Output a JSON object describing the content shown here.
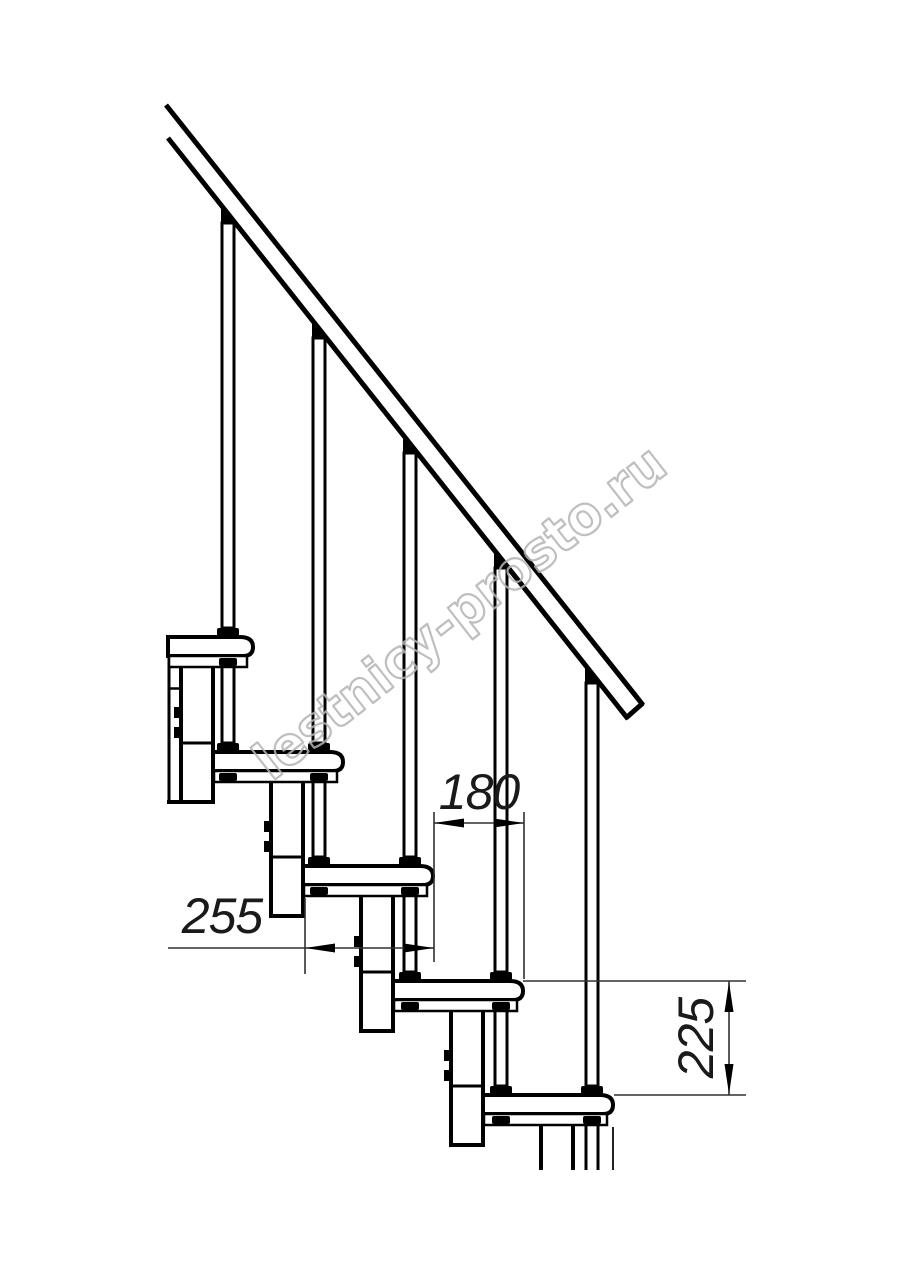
{
  "page": {
    "background": "#ffffff",
    "description": "Technical side-view drawing of a modular staircase"
  },
  "watermark": {
    "text": "lestnicy-prosto.ru",
    "color": "#b4b4b4"
  },
  "dimensions": {
    "tread_length_label": "255",
    "run_label": "180",
    "rise_label": "225"
  },
  "drawing": {
    "line_color": "#000000",
    "treads_count": 5,
    "baluster_rods_count": 5,
    "support_columns_count": 5
  }
}
